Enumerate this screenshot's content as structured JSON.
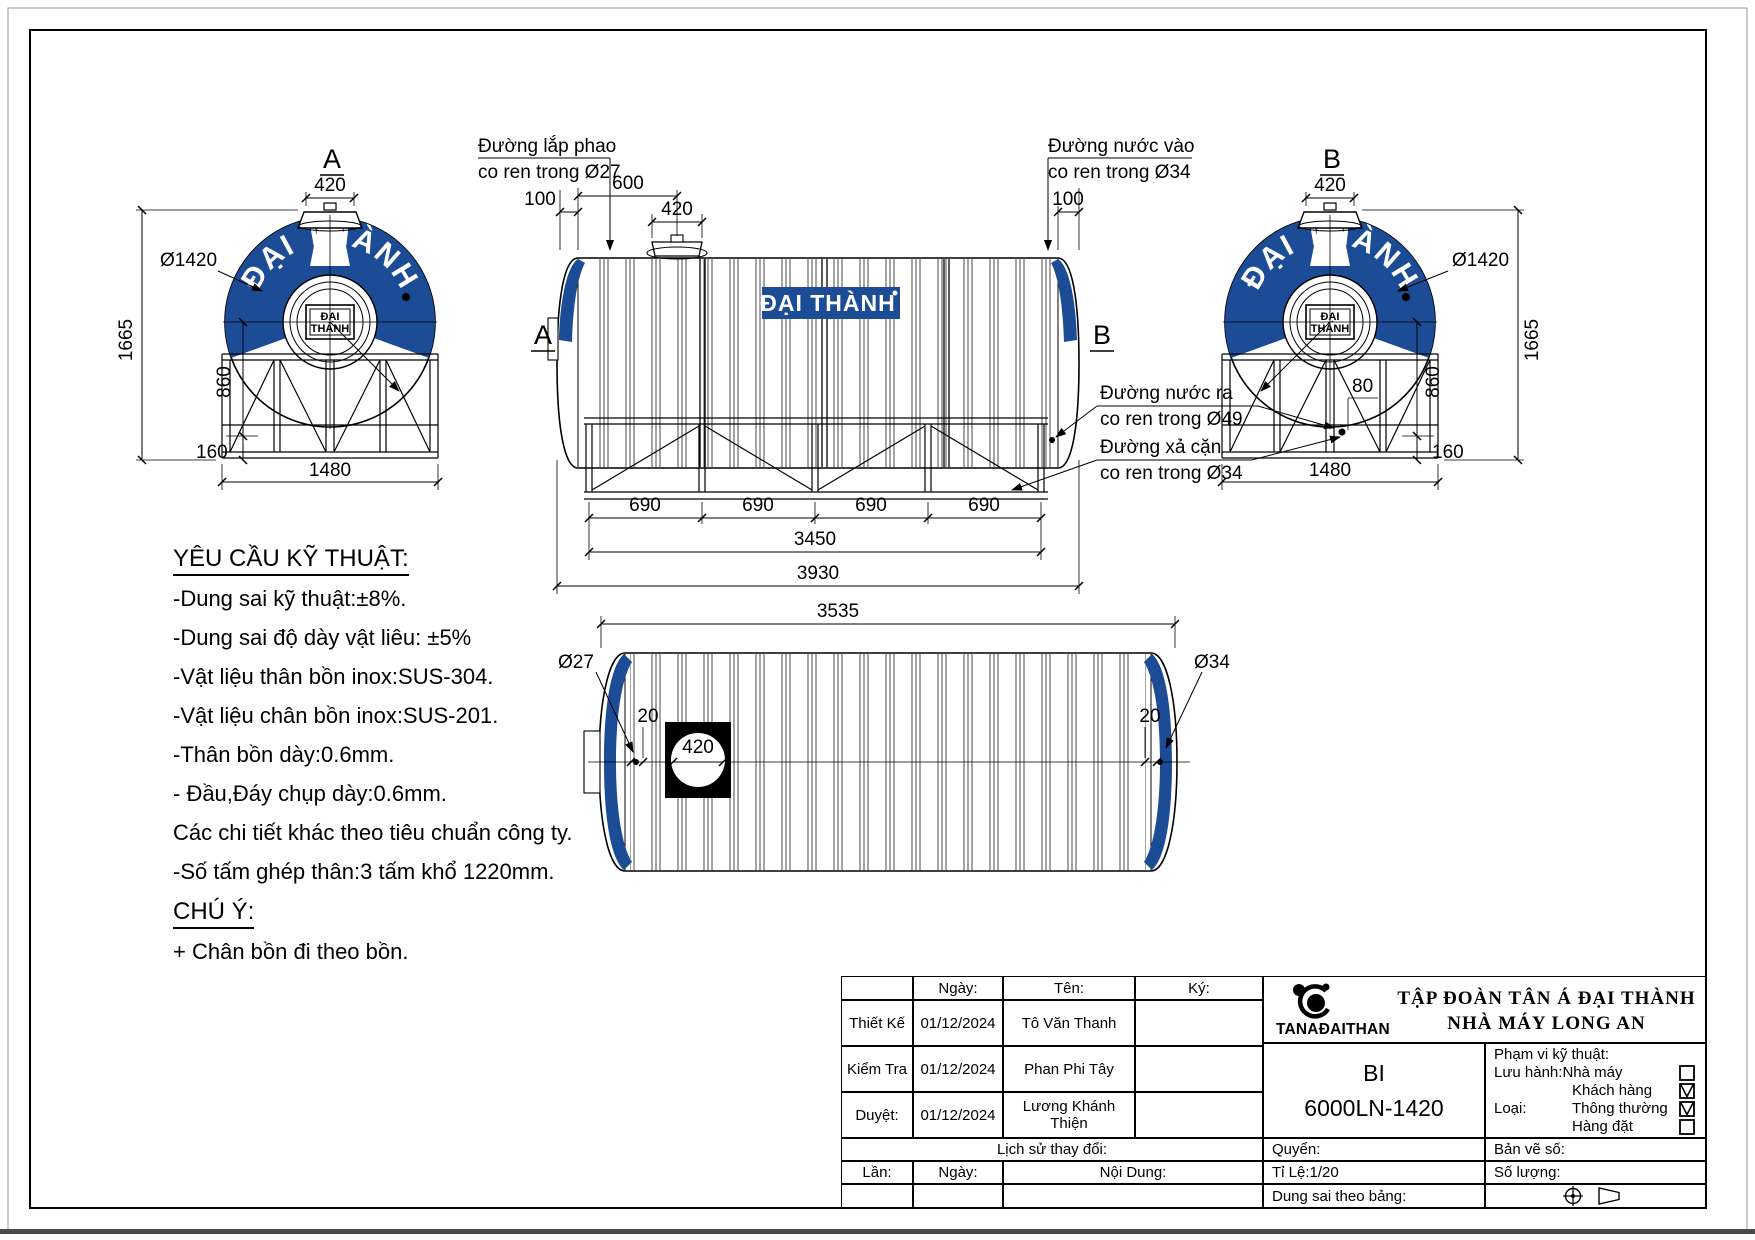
{
  "page": {
    "accent_blue": "#1d4c96",
    "line_color": "#000000"
  },
  "views": {
    "front": {
      "label": "A",
      "dim_top": "420",
      "dia": "Ø1420",
      "dim_height": "1665",
      "dim_mid": "860",
      "dim_base": "160",
      "dim_width": "1480",
      "band_text": "ĐẠI THÀNH",
      "hub_line1": "ĐẠI",
      "hub_line2": "THÀNH"
    },
    "back": {
      "label": "B",
      "dim_top": "420",
      "dia": "Ø1420",
      "dim_height": "1665",
      "dim_mid": "860",
      "dim_base": "160",
      "dim_width": "1480",
      "dim_offset": "80",
      "band_text": "ĐẠI THÀNH",
      "hub_line1": "ĐẠI",
      "hub_line2": "THÀNH"
    },
    "side": {
      "section_a": "A",
      "section_b": "B",
      "float_label_1": "Đường lắp phao",
      "float_label_2": "co ren trong Ø27",
      "inlet_label_1": "Đường nước vào",
      "inlet_label_2": "co ren trong Ø34",
      "outlet_label_1": "Đường nước ra",
      "outlet_label_2": "co ren trong Ø49",
      "drain_label_1": "Đường xả cặn",
      "drain_label_2": "co ren trong Ø34",
      "dim_600": "600",
      "dim_420": "420",
      "dim_100_left": "100",
      "dim_100_right": "100",
      "dim_bay": "690",
      "dim_3450": "3450",
      "dim_3930": "3930",
      "plate_text": "ĐẠI THÀNH"
    },
    "top": {
      "dim_length": "3535",
      "dia_left": "Ø27",
      "dia_right": "Ø34",
      "dim_edge_left": "20",
      "dim_edge_right": "20",
      "dim_manhole": "420"
    }
  },
  "tech": {
    "title": "YÊU CẦU KỸ THUẬT:",
    "items": [
      "-Dung sai kỹ thuật:±8%.",
      "-Dung sai độ dày vật liêu: ±5%",
      "-Vật liệu thân bồn inox:SUS-304.",
      "-Vật liệu chân bồn inox:SUS-201.",
      "-Thân bồn dày:0.6mm.",
      "- Đầu,Đáy chụp dày:0.6mm.",
      "Các chi tiết khác theo tiêu chuẩn công ty.",
      "-Số tấm ghép thân:3 tấm khổ 1220mm."
    ],
    "note_title": "CHÚ Ý:",
    "note_items": [
      "+ Chân bồn đi theo bồn."
    ]
  },
  "title_block": {
    "col_headers": {
      "date": "Ngày:",
      "name": "Tên:",
      "sign": "Ký:"
    },
    "rows": [
      {
        "role": "Thiết Kế",
        "date": "01/12/2024",
        "name": "Tô Văn Thanh"
      },
      {
        "role": "Kiểm Tra",
        "date": "01/12/2024",
        "name": "Phan Phi Tây"
      },
      {
        "role": "Duyệt:",
        "date": "01/12/2024",
        "name": "Lương Khánh Thiện"
      }
    ],
    "history_label": "Lịch sử thay đổi:",
    "rev_headers": {
      "no": "Lần:",
      "date": "Ngày:",
      "content": "Nội Dung:"
    },
    "company": {
      "logo_text": "TANAĐAITHANH",
      "line1": "TẬP ĐOÀN TÂN Á ĐẠI THÀNH",
      "line2": "NHÀ MÁY LONG AN"
    },
    "model": {
      "line1": "BI",
      "line2": "6000LN-1420"
    },
    "rights_label": "Quyển:",
    "scale_label": "Tỉ Lệ:1/20",
    "tolerance_label": "Dung sai theo bảng:",
    "drawing_no_label": "Bản vẽ số:",
    "quantity_label": "Số lượng:",
    "scope": {
      "title": "Phạm vi kỹ thuật:",
      "circulation_label": "Lưu hành:",
      "type_label": "Loại:",
      "options": [
        {
          "label": "Nhà máy",
          "checked": false
        },
        {
          "label": "Khách hàng",
          "checked": true
        },
        {
          "label": "Thông thường",
          "checked": true
        },
        {
          "label": "Hàng đặt",
          "checked": false
        }
      ]
    }
  }
}
